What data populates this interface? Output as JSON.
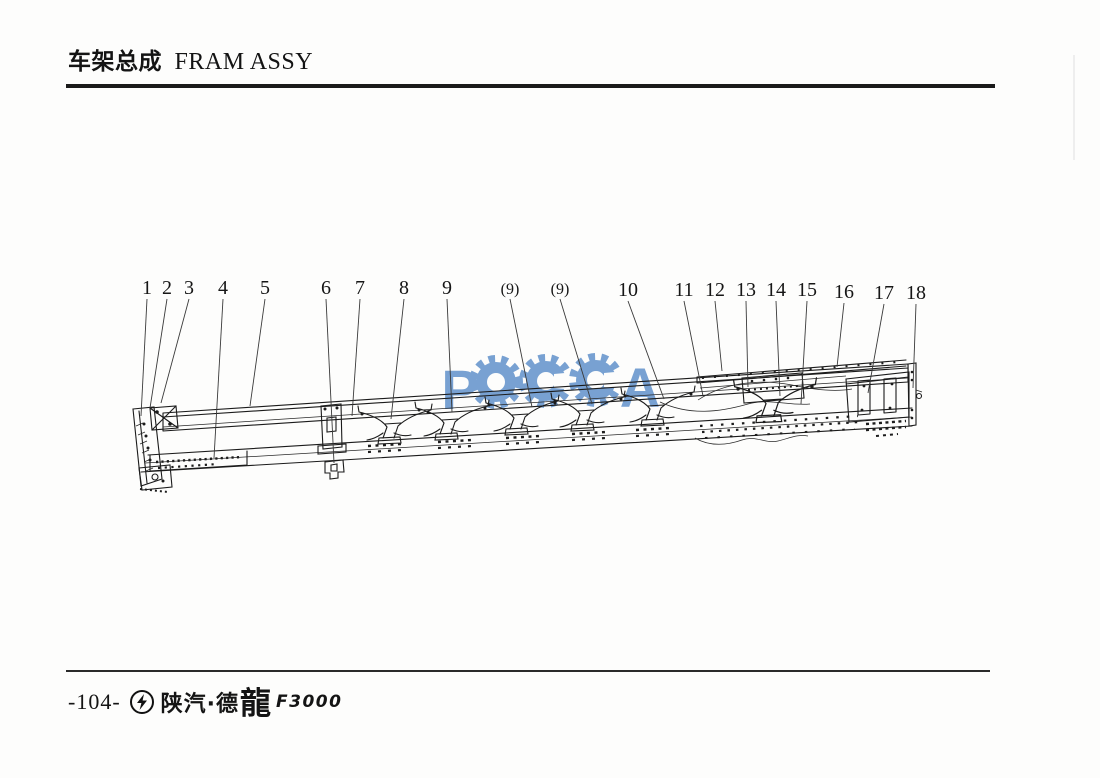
{
  "header": {
    "title_cn": "车架总成",
    "title_en": "FRAM ASSY"
  },
  "watermark": {
    "text": "POCCA",
    "letters": [
      "P",
      "O",
      "C",
      "C",
      "A"
    ],
    "color": "#5b8ec9",
    "gear_icons": 3
  },
  "diagram": {
    "description": "frame-assembly-line-drawing",
    "callouts": [
      {
        "label": "1",
        "lx": 147,
        "ly": 294,
        "tx": 141,
        "ty": 416
      },
      {
        "label": "2",
        "lx": 167,
        "ly": 294,
        "tx": 150,
        "ty": 408
      },
      {
        "label": "3",
        "lx": 189,
        "ly": 294,
        "tx": 161,
        "ty": 403
      },
      {
        "label": "4",
        "lx": 223,
        "ly": 294,
        "tx": 214,
        "ty": 458
      },
      {
        "label": "5",
        "lx": 265,
        "ly": 294,
        "tx": 250,
        "ty": 406
      },
      {
        "label": "6",
        "lx": 326,
        "ly": 294,
        "tx": 334,
        "ty": 463
      },
      {
        "label": "7",
        "lx": 360,
        "ly": 294,
        "tx": 352,
        "ty": 416
      },
      {
        "label": "8",
        "lx": 404,
        "ly": 294,
        "tx": 391,
        "ty": 419
      },
      {
        "label": "9",
        "lx": 447,
        "ly": 294,
        "tx": 452,
        "ty": 412
      },
      {
        "label": "(9)",
        "lx": 510,
        "ly": 294,
        "tx": 532,
        "ty": 407
      },
      {
        "label": "(9)",
        "lx": 560,
        "ly": 294,
        "tx": 592,
        "ty": 404
      },
      {
        "label": "10",
        "lx": 628,
        "ly": 296,
        "tx": 664,
        "ty": 399
      },
      {
        "label": "11",
        "lx": 684,
        "ly": 296,
        "tx": 703,
        "ty": 396
      },
      {
        "label": "12",
        "lx": 715,
        "ly": 296,
        "tx": 722,
        "ty": 371
      },
      {
        "label": "13",
        "lx": 746,
        "ly": 296,
        "tx": 748,
        "ty": 387
      },
      {
        "label": "14",
        "lx": 776,
        "ly": 296,
        "tx": 780,
        "ty": 396
      },
      {
        "label": "15",
        "lx": 807,
        "ly": 296,
        "tx": 801,
        "ty": 404
      },
      {
        "label": "16",
        "lx": 844,
        "ly": 298,
        "tx": 837,
        "ty": 367
      },
      {
        "label": "17",
        "lx": 884,
        "ly": 299,
        "tx": 868,
        "ty": 393
      },
      {
        "label": "18",
        "lx": 916,
        "ly": 299,
        "tx": 913,
        "ty": 388
      }
    ]
  },
  "footer": {
    "page": "-104-",
    "brand_cn": "陕汽·德",
    "brand_dragon": "龍",
    "brand_model": "F3000"
  }
}
